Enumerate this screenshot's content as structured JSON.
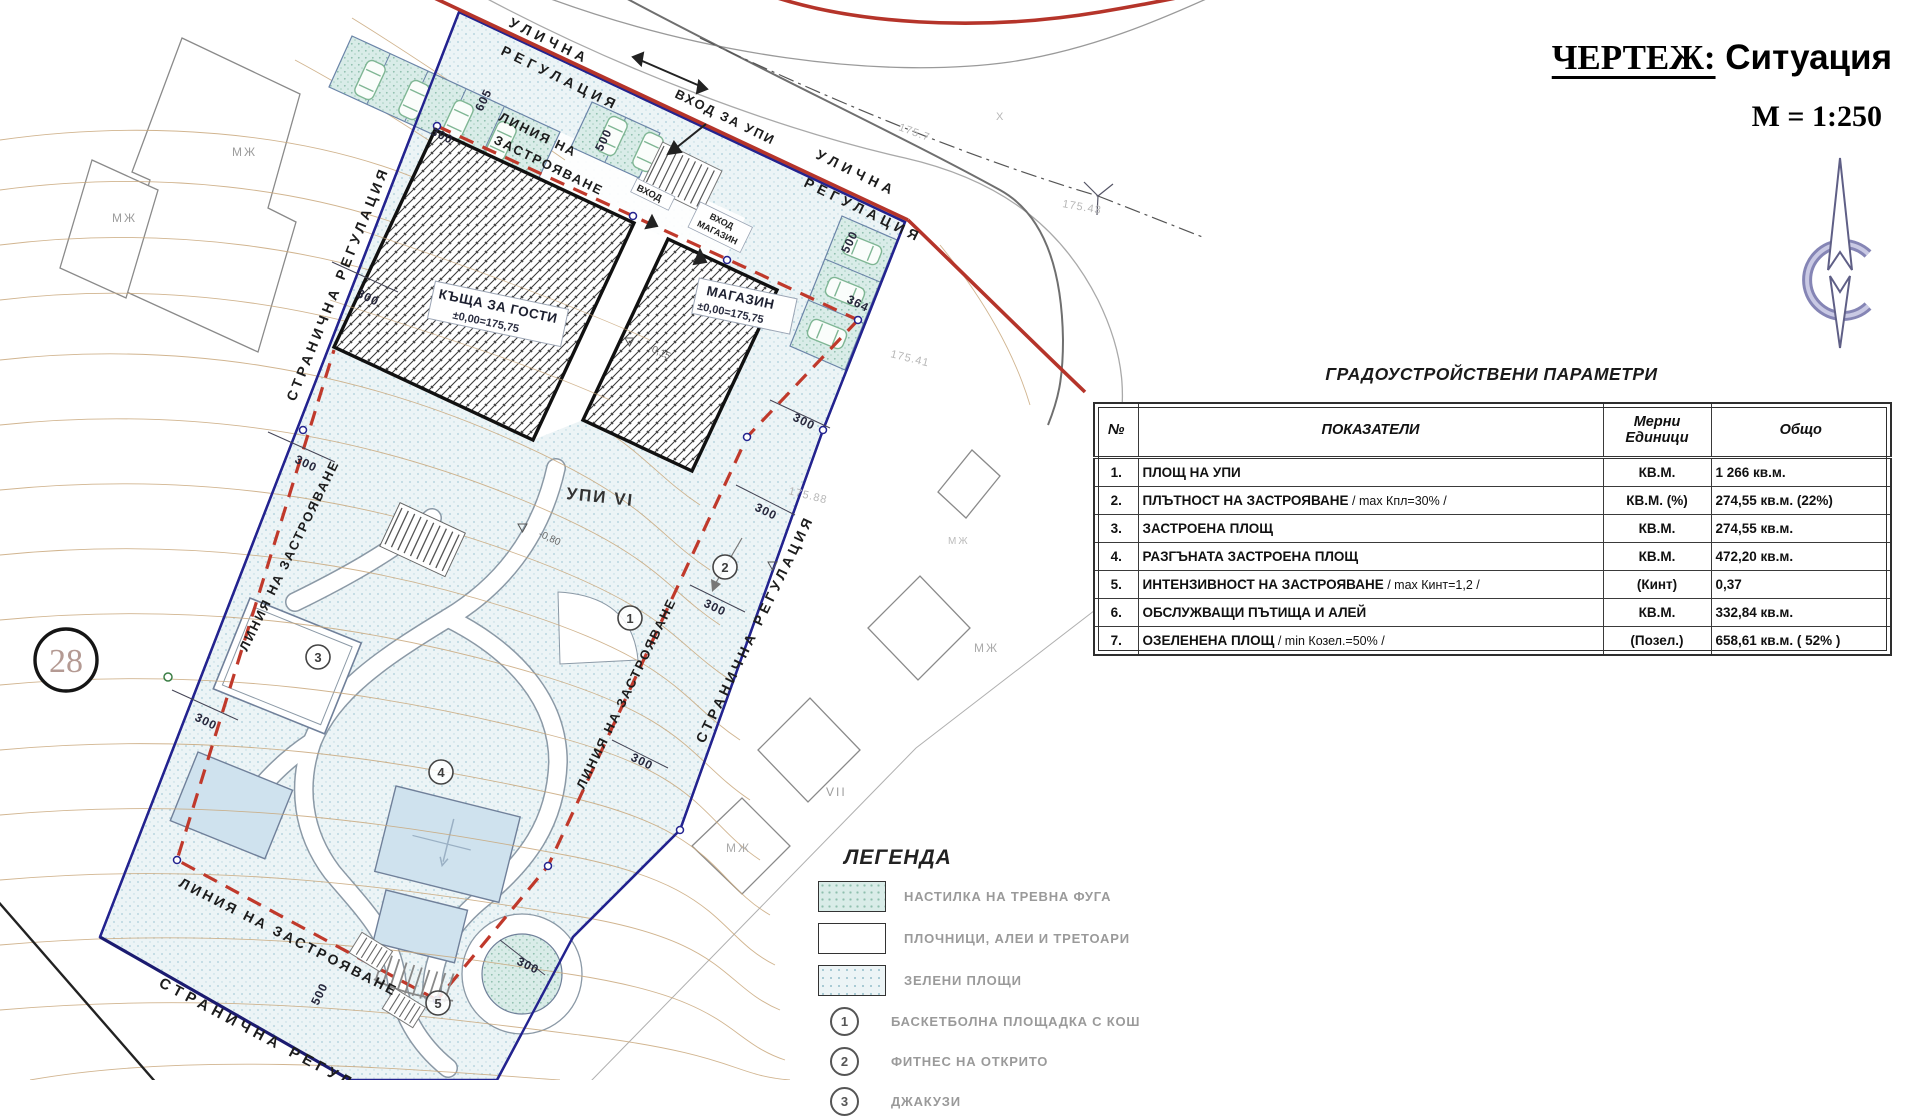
{
  "title_block": {
    "drawing_label": "ЧЕРТЕЖ:",
    "drawing_name": " Ситуация",
    "scale": "М = 1:250"
  },
  "params_table": {
    "title": "ГРАДОУСТРОЙСТВЕНИ  ПАРАМЕТРИ",
    "col_num": "№",
    "col_indicator": "ПОКАЗАТЕЛИ",
    "col_unit1": "Мерни",
    "col_unit2": "Единици",
    "col_total": "Общо",
    "rows": [
      {
        "n": "1.",
        "name": "ПЛОЩ НА УПИ",
        "note": "",
        "unit": "КВ.М.",
        "total": "1 266 кв.м."
      },
      {
        "n": "2.",
        "name": "ПЛЪТНОСТ НА ЗАСТРОЯВАНЕ",
        "note": " / max Кпл=30% /",
        "unit": "КВ.М. (%)",
        "total": "274,55 кв.м. (22%)"
      },
      {
        "n": "3.",
        "name": "ЗАСТРОЕНА ПЛОЩ",
        "note": "",
        "unit": "КВ.М.",
        "total": "274,55 кв.м."
      },
      {
        "n": "4.",
        "name": "РАЗГЪНАТА ЗАСТРОЕНА ПЛОЩ",
        "note": "",
        "unit": "КВ.М.",
        "total": "472,20 кв.м."
      },
      {
        "n": "5.",
        "name": "ИНТЕНЗИВНОСТ НА ЗАСТРОЯВАНЕ",
        "note": " / max Кинт=1,2 /",
        "unit": "(Кинт)",
        "total": "0,37"
      },
      {
        "n": "6.",
        "name": "ОБСЛУЖВАЩИ ПЪТИЩА И АЛЕЙ",
        "note": "",
        "unit": "КВ.М.",
        "total": "332,84 кв.м."
      },
      {
        "n": "7.",
        "name": "ОЗЕЛЕНЕНА ПЛОЩ",
        "note": " / min Козел.=50% /",
        "unit": "(Позел.)",
        "total": "658,61 кв.м. ( 52% )"
      }
    ]
  },
  "legend": {
    "title": "ЛЕГЕНДА",
    "items": [
      {
        "label": "НАСТИЛКА НА ТРЕВНА ФУГА"
      },
      {
        "label": "ПЛОЧНИЦИ, АЛЕИ И ТРЕТОАРИ"
      },
      {
        "label": "ЗЕЛЕНИ ПЛОЩИ"
      }
    ],
    "markers": [
      {
        "num": "1",
        "label": "БАСКЕТБОЛНА ПЛОЩАДКА С КОШ"
      },
      {
        "num": "2",
        "label": "ФИТНЕС НА ОТКРИТО"
      },
      {
        "num": "3",
        "label": "ДЖАКУЗИ"
      }
    ]
  },
  "plan": {
    "labels": {
      "street_reg_top1": "УЛИЧНА",
      "street_reg_top2": "РЕГУЛАЦИЯ",
      "street_reg_right1": "УЛИЧНА",
      "street_reg_right2": "РЕГУЛАЦИЯ",
      "building_line_top1": "ЛИНИЯ НА",
      "building_line_top2": "ЗАСТРОЯВАНЕ",
      "entry_upi": "ВХОД ЗА УПИ",
      "entry": "ВХОД",
      "entry_shop1": "ВХОД",
      "entry_shop2": "МАГАЗИН",
      "side_reg_left": "СТРАНИЧНА РЕГУЛАЦИЯ",
      "side_reg_right": "СТРАНИЧНА РЕГУЛАЦИЯ",
      "side_reg_bottom": "СТРАНИЧНА РЕГУЛАЦИЯ",
      "building_line_left": "ЛИНИЯ НА ЗАСТРОЯВАНЕ",
      "building_line_mid": "ЛИНИЯ НА ЗАСТРОЯВАНЕ",
      "building_line_bottom": "ЛИНИЯ НА ЗАСТРОЯВАНЕ",
      "guest_house1": "КЪЩА ЗА ГОСТИ",
      "guest_house2": "±0,00=175,75",
      "shop1": "МАГАЗИН",
      "shop2": "±0,00=175,75",
      "upi": "УПИ VI",
      "level1": "-0,15",
      "level2": "-0,80",
      "parcel_number": "28"
    },
    "dims": [
      "605",
      "300",
      "500",
      "500",
      "364",
      "300",
      "300",
      "300",
      "300",
      "300",
      "300",
      "300",
      "300",
      "500"
    ],
    "marker_nums": [
      "1",
      "2",
      "3",
      "4",
      "5"
    ],
    "faint": [
      "175.41",
      "175.88",
      "175.43",
      "175.7",
      "X",
      "МЖ",
      "МЖ",
      "МЖ",
      "МЖ",
      "МЖ",
      "VII"
    ],
    "colors": {
      "regulation_red": "#b5342a",
      "boundary_blue": "#23238f",
      "building_black": "#111111",
      "contour_tan": "#c9a87c",
      "green_area": "#ecf4f6",
      "grass_paving": "#d9ece8"
    }
  }
}
